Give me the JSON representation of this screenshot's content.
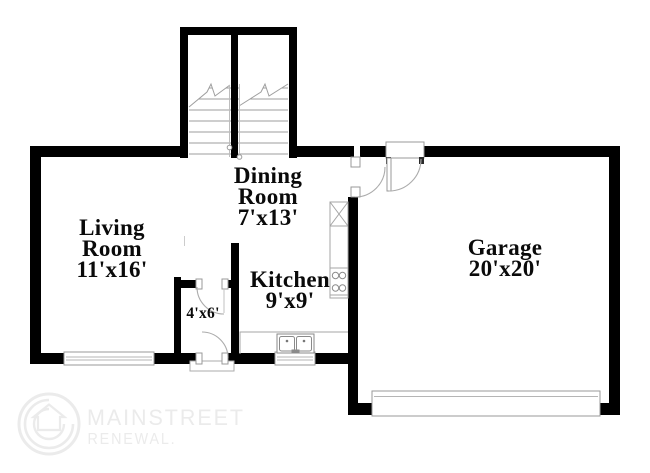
{
  "rooms": {
    "living": {
      "line1": "Living",
      "line2": "Room",
      "dims": "11'x16'"
    },
    "dining": {
      "line1": "Dining",
      "line2": "Room",
      "dims": "7'x13'"
    },
    "kitchen": {
      "line1": "Kitchen",
      "dims": "9'x9'"
    },
    "garage": {
      "line1": "Garage",
      "dims": "20'x20'"
    },
    "closet": {
      "dims": "4'x6'"
    }
  },
  "watermark": {
    "brand": "MAINSTREET",
    "subtitle": "RENEWAL."
  },
  "colors": {
    "wall": "#000000",
    "fixture_line": "#a5a5a5",
    "label_text": "#0a0a0a",
    "watermark": "#ebebeb"
  },
  "fixtures": [
    "staircase-left",
    "staircase-right",
    "window-living",
    "window-kitchen",
    "garage-door",
    "entry-door",
    "closet-door",
    "dining-door",
    "garage-entry-door",
    "refrigerator",
    "range-burners",
    "kitchen-sink",
    "kitchen-counter"
  ]
}
